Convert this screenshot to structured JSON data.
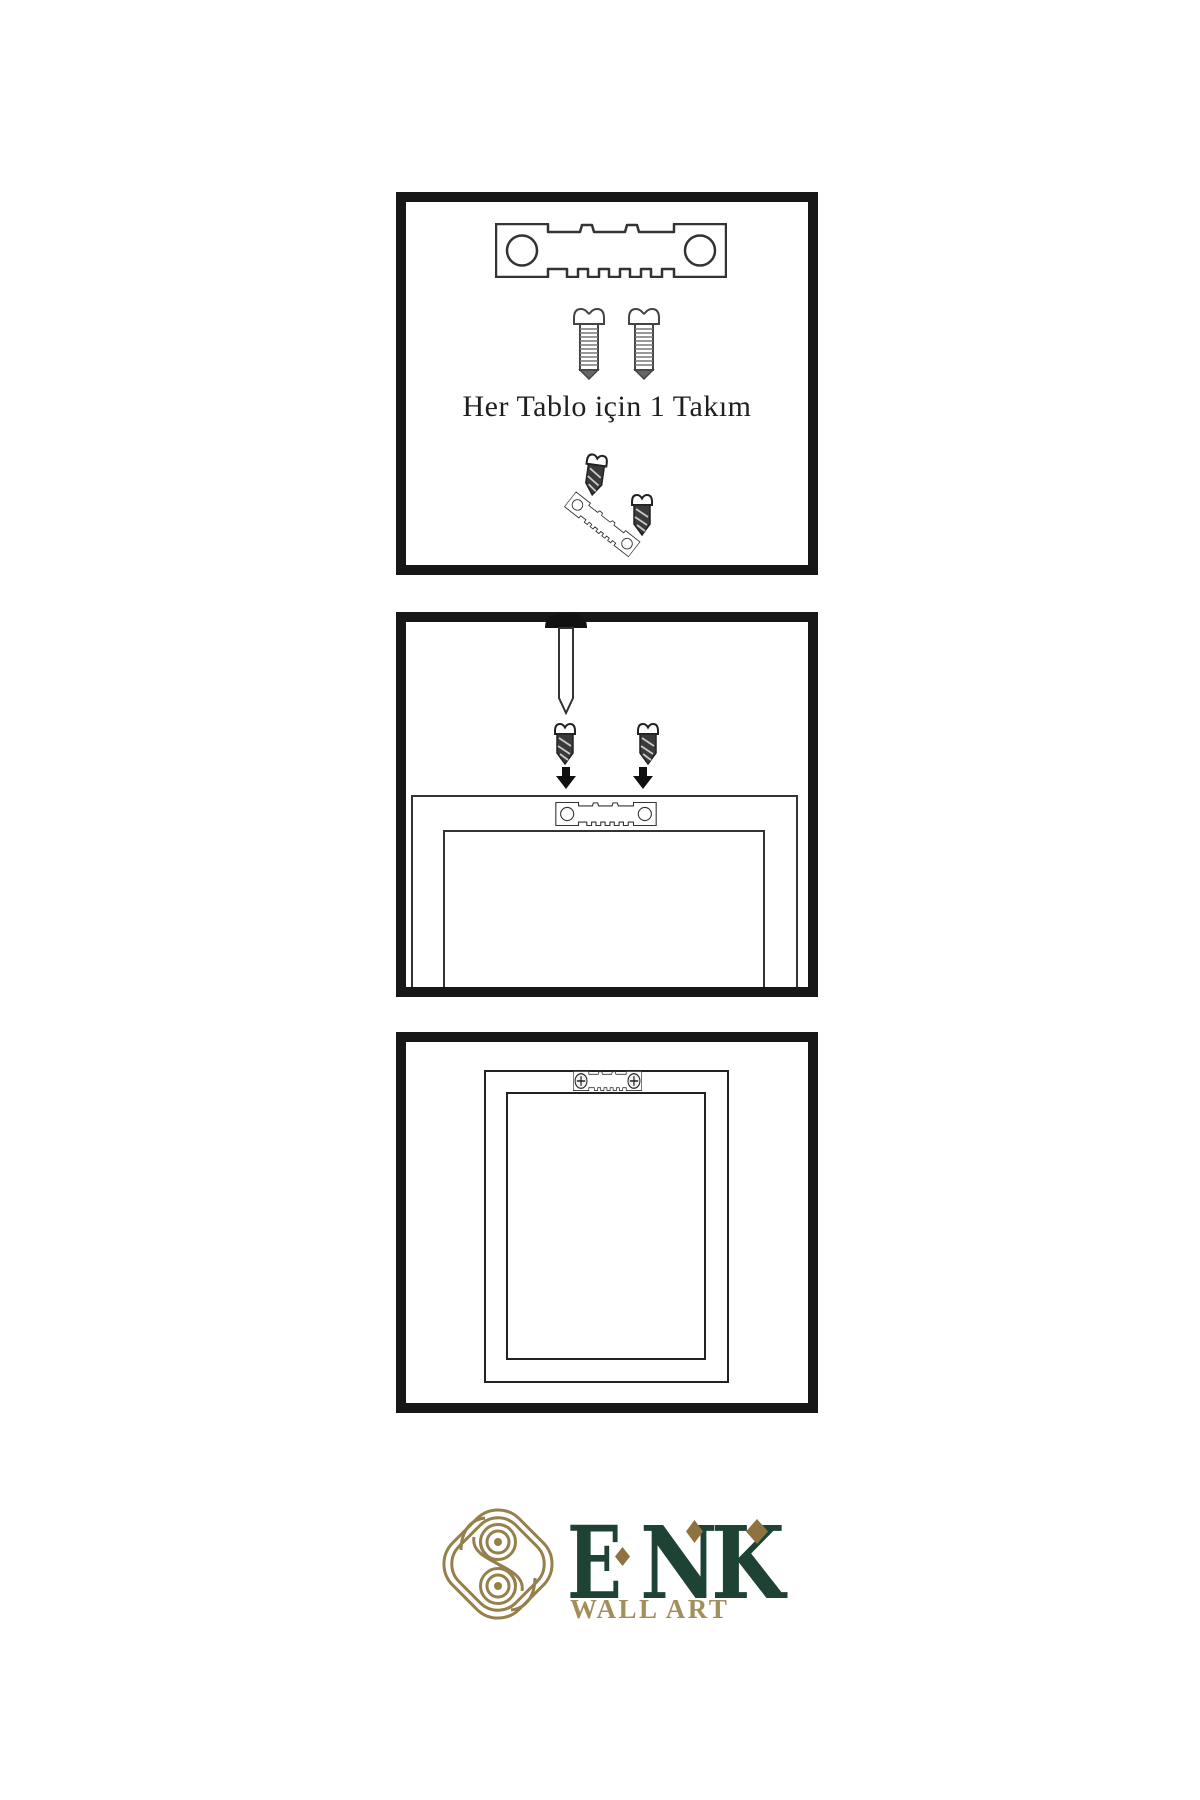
{
  "page": {
    "background": "#ffffff"
  },
  "steps": [
    {
      "id": 1,
      "name": "hardware-kit",
      "caption": "Her Tablo için 1 Takım",
      "items": [
        "sawtooth-hanger",
        "screw",
        "screw",
        "screw",
        "sawtooth-hanger-angled",
        "screw"
      ]
    },
    {
      "id": 2,
      "name": "attach-hanger-to-frame-back",
      "items": [
        "wall-nail",
        "screw",
        "screw",
        "arrow-down",
        "arrow-down",
        "sawtooth-hanger",
        "frame-back"
      ]
    },
    {
      "id": 3,
      "name": "hanger-mounted-on-frame",
      "items": [
        "frame-front",
        "sawtooth-hanger-mounted"
      ]
    }
  ],
  "brand": {
    "letters": [
      "E",
      "N",
      "K"
    ],
    "tagline": "WALL ART"
  },
  "colors": {
    "panel_border": "#171717",
    "line_art": "#333333",
    "screw_shaft_dark": "#3a3a3a",
    "brand_green": "#1e4233",
    "brand_gold": "#95804b",
    "brand_gold_dark": "#8c7340",
    "brand_gold_text": "#a38f5c"
  }
}
